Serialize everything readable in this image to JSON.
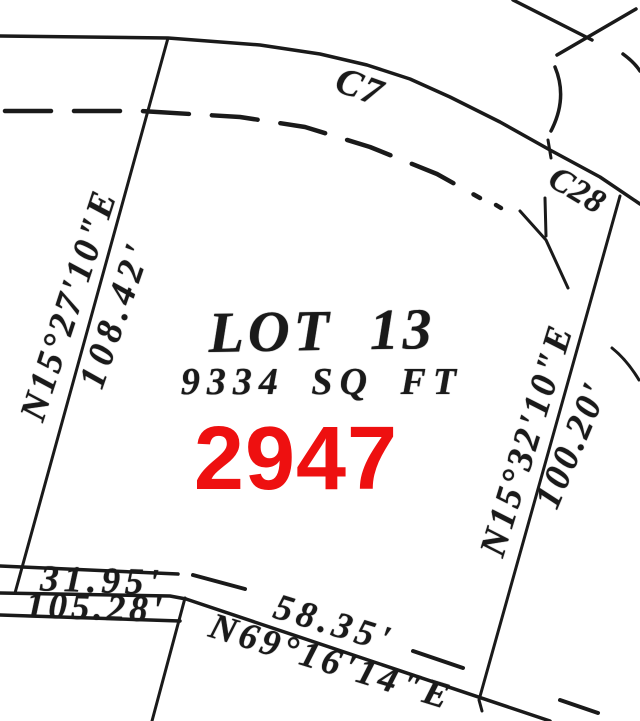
{
  "colors": {
    "ink": "#1a1a1a",
    "parcel_red": "#ee1010",
    "background": "#ffffff"
  },
  "plat": {
    "title": "LOT 13",
    "area": "9334 SQ FT",
    "parcel_number": "2947",
    "curve_labels": {
      "c7": "C7",
      "c28": "C28"
    },
    "left_boundary": {
      "bearing": "N15°27'10\"E",
      "distance": "108.42'"
    },
    "right_boundary": {
      "bearing": "N15°32'10\"E",
      "distance": "100.20'"
    },
    "bottom_boundary": {
      "upper_distance": "31.95'",
      "lower_distance": "105.28'"
    },
    "diagonal_boundary": {
      "distance": "58.35'",
      "bearing": "N69°16'14\"E"
    }
  }
}
